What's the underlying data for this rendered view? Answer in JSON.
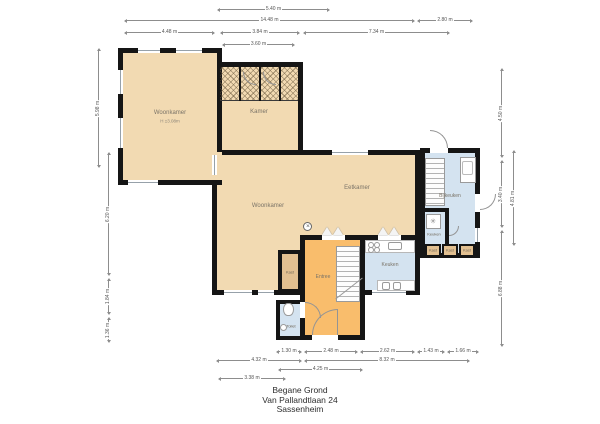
{
  "title": {
    "line1": "Begane Grond",
    "line2": "Van Pallandtlaan 24",
    "line3": "Sassenheim"
  },
  "rooms": {
    "woonkamer_upper": {
      "label": "Woonkamer",
      "sublabel": "H ±3.08m"
    },
    "kamer": {
      "label": "Kamer"
    },
    "woonkamer": {
      "label": "Woonkamer"
    },
    "eetkamer": {
      "label": "Eetkamer"
    },
    "keuken": {
      "label": "Keuken"
    },
    "keuken_small": {
      "label": "Keuken"
    },
    "bijkeuken": {
      "label": "Bijkeuken"
    },
    "entree": {
      "label": "Entree"
    },
    "kast": {
      "label": "Kast"
    },
    "toilet": {
      "label": "Toilet"
    },
    "kast_units": [
      "Kast",
      "Kast",
      "Kast"
    ]
  },
  "dimensions": {
    "top": [
      "5.40 m",
      "14.48 m",
      "2.80 m",
      "4.48 m",
      "3.84 m",
      "7.34 m",
      "3.60 m"
    ],
    "bottom": [
      "1.30 m",
      "2.48 m",
      "2.62 m",
      "1.43 m",
      "1.66 m",
      "4.32 m",
      "8.32 m",
      "4.25 m",
      "3.38 m"
    ],
    "left": [
      "5.98 m",
      "6.20 m",
      "1.84 m",
      "1.36 m"
    ],
    "right": [
      "4.50 m",
      "3.40 m",
      "6.88 m",
      "4.81 m"
    ]
  },
  "icons": {
    "meter": "✕",
    "freezer": "✳"
  },
  "colors": {
    "room_tan": "#F2DAB2",
    "entree_orange": "#F9BD6C",
    "wet_room_blue": "#D4E3F0",
    "closet_tan": "#E2C091",
    "wall_black": "#151515"
  }
}
